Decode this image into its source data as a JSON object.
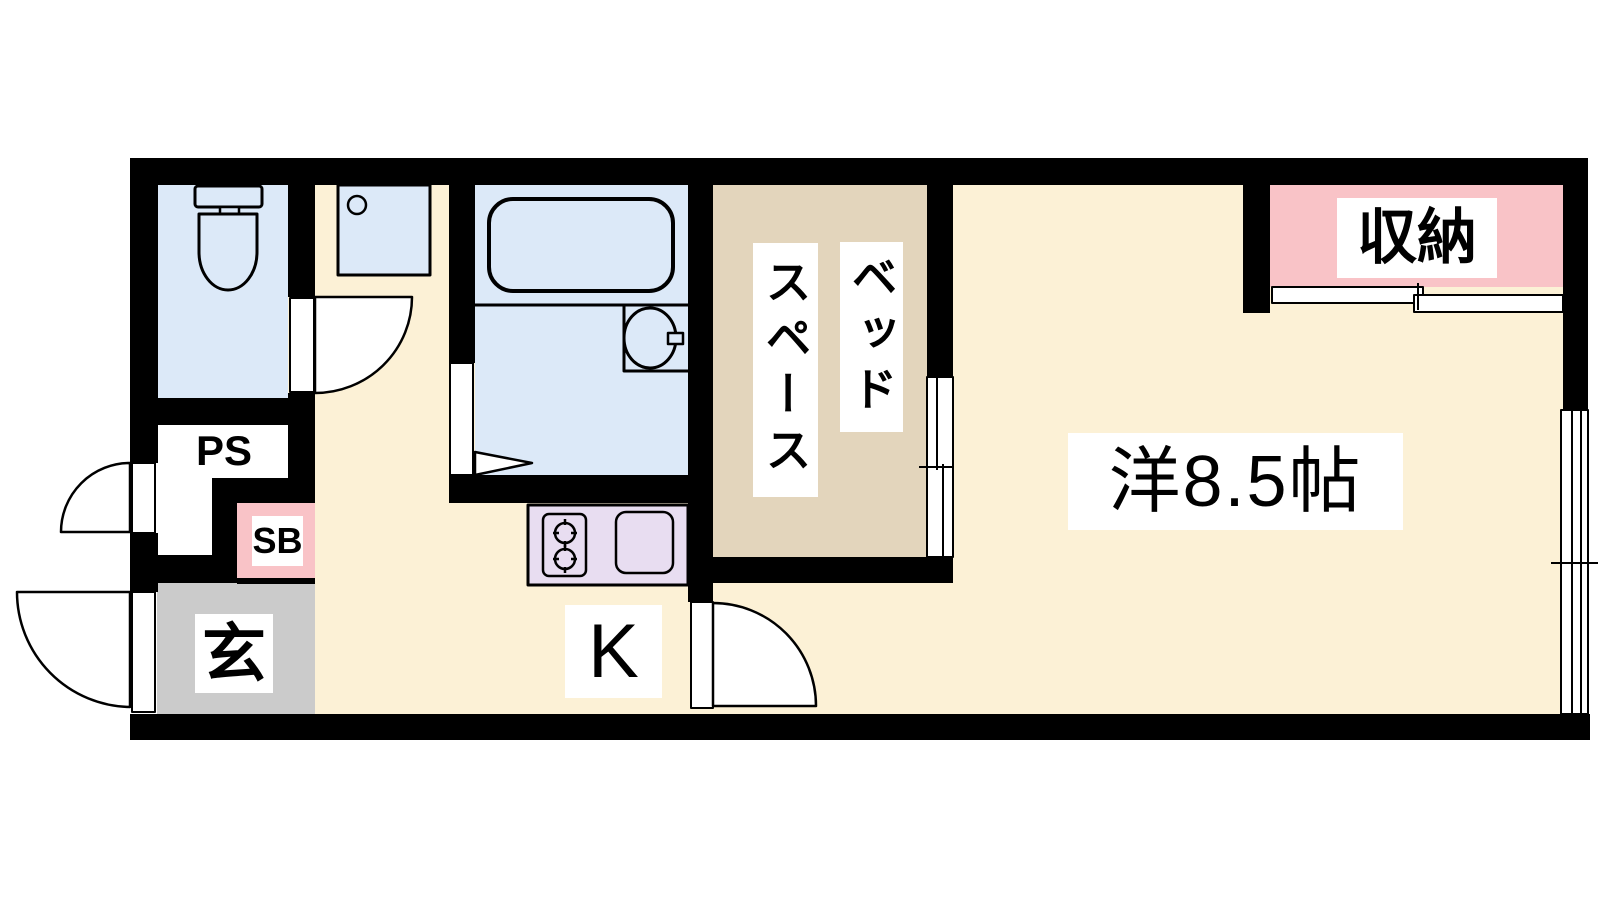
{
  "colors": {
    "wall": "#000000",
    "floor": "#FCF1D6",
    "wet_area": "#DCE9F8",
    "bed_space": "#E3D5BC",
    "pink": "#F9C3C7",
    "kitchen_counter": "#E8DDF1",
    "entrance_gray": "#CBCBCB",
    "label_bg": "#FFFFFF"
  },
  "rooms": {
    "main_room": {
      "label": "洋8.5帖"
    },
    "bed_space": {
      "label_right": "ベッド",
      "label_left": "スペース"
    },
    "kitchen": {
      "label": "K"
    },
    "storage": {
      "label": "収納"
    },
    "entrance": {
      "label": "玄"
    },
    "pipe_space": {
      "label": "PS"
    },
    "shoe_box": {
      "label": "SB"
    }
  }
}
